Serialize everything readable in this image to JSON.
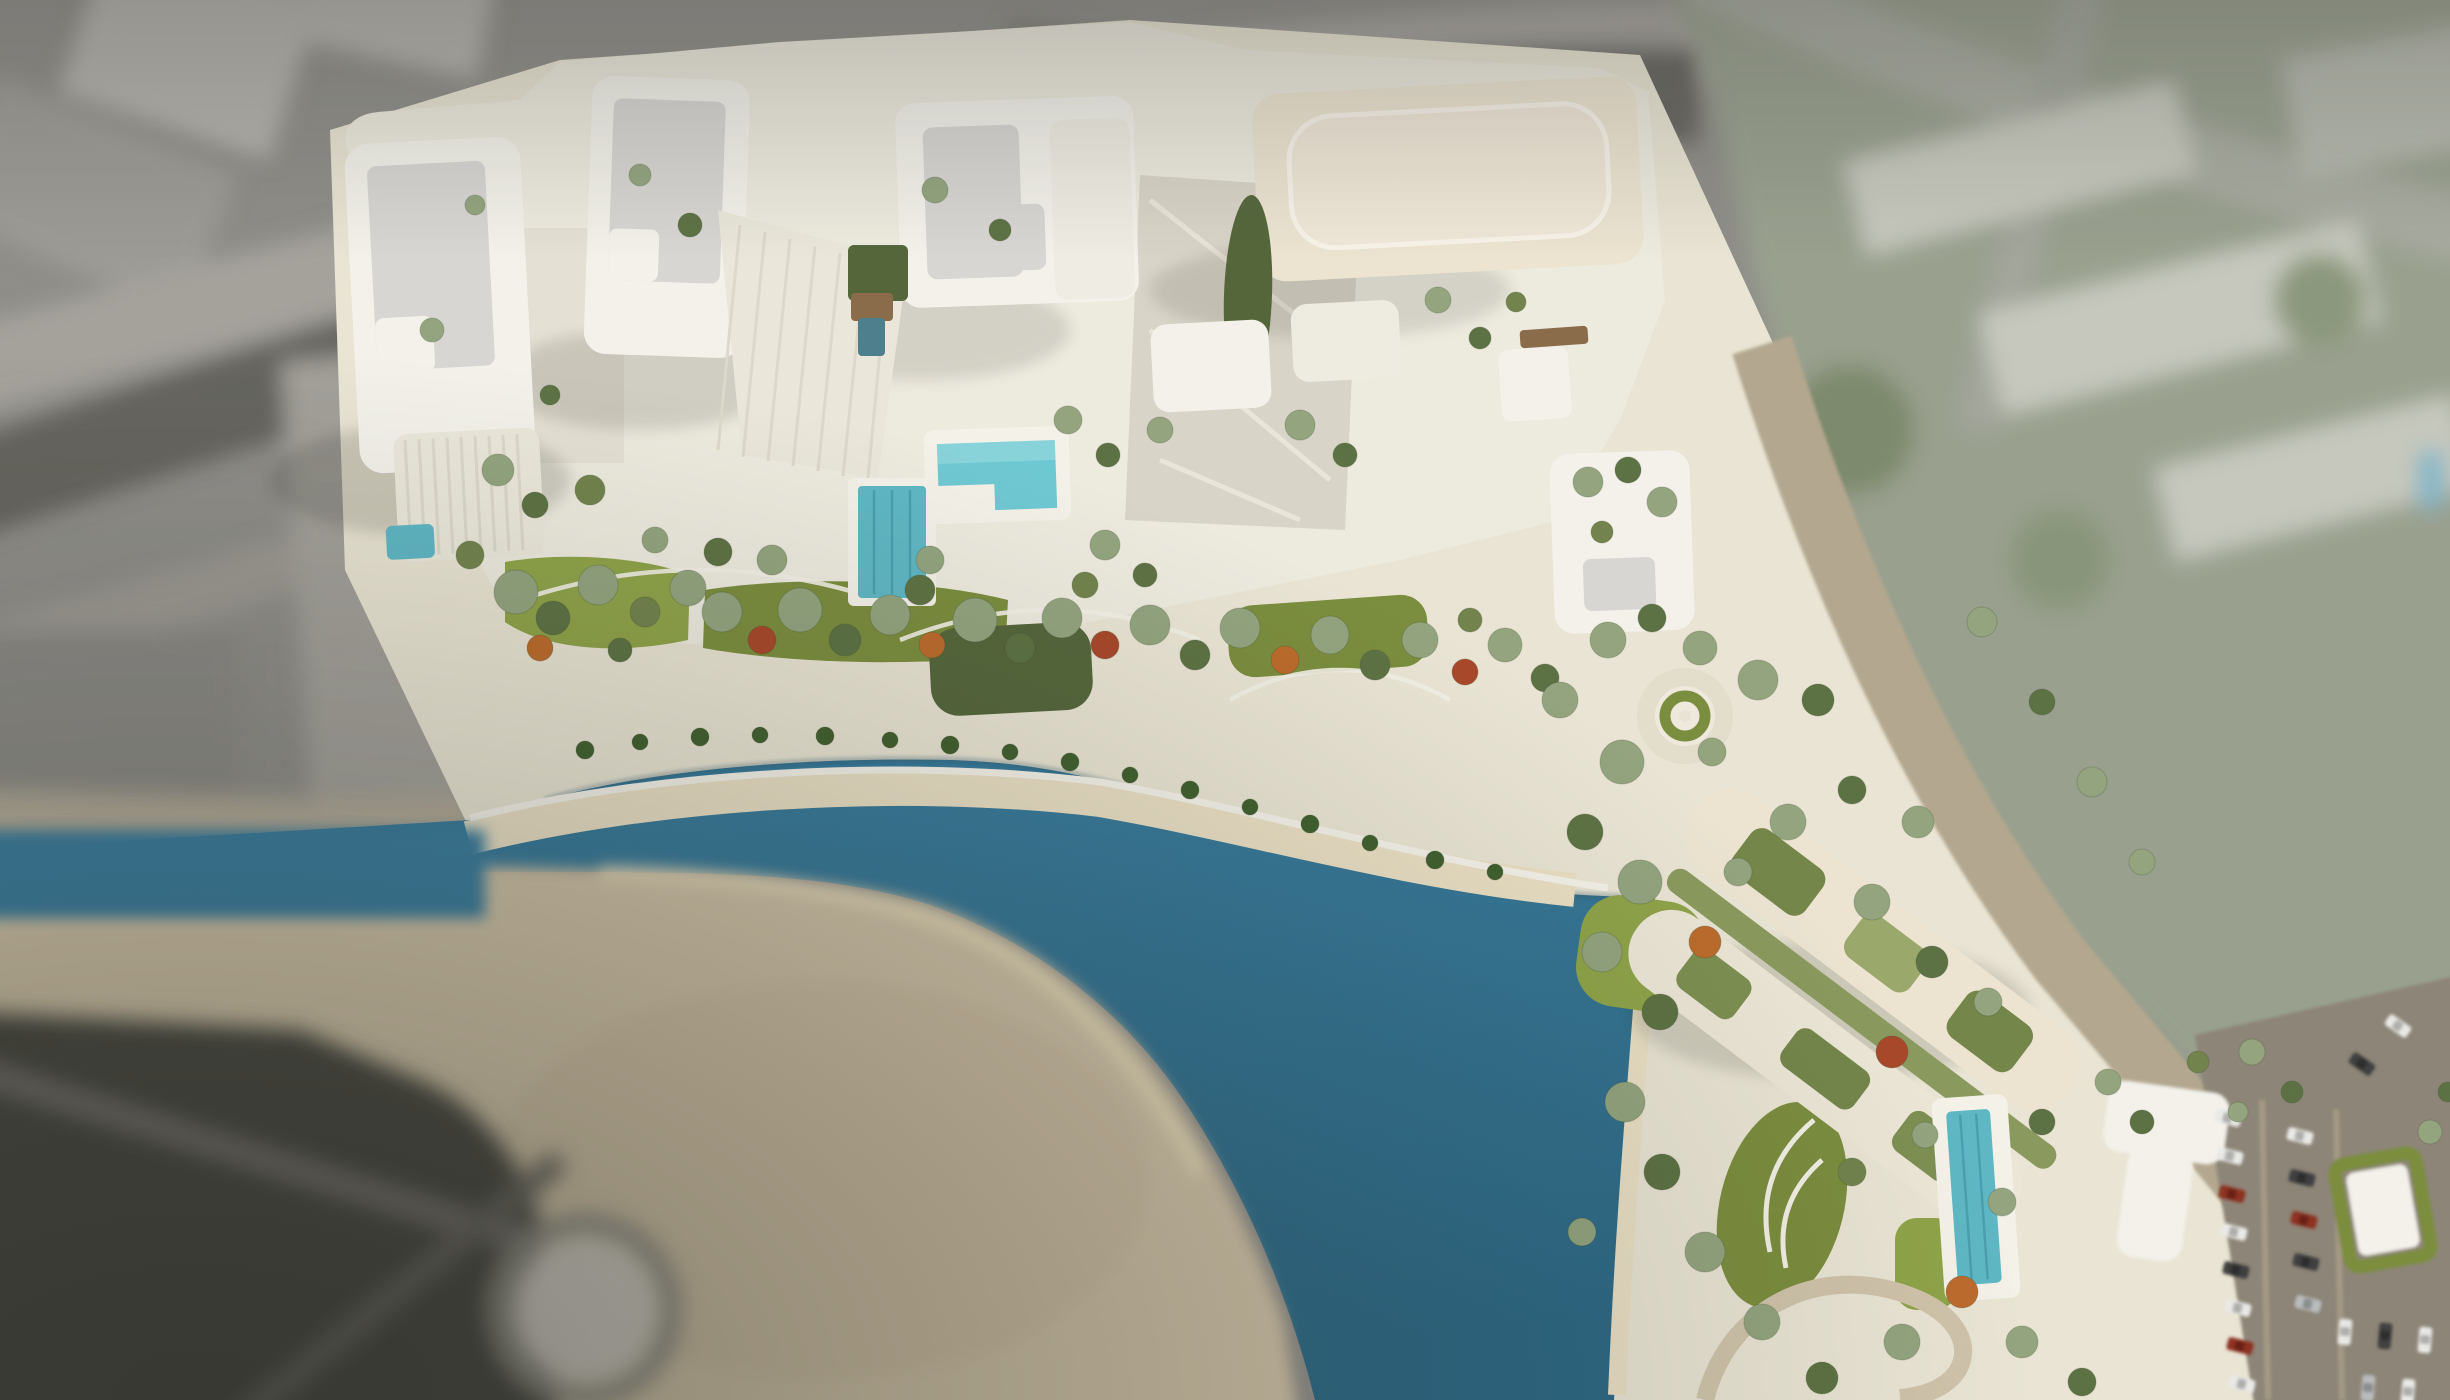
{
  "scene": {
    "type": "aerial-architectural-render",
    "subject": "waterfront resort masterplan with white towers, landscaped gardens, pools, turquoise lagoon and sandy beach",
    "view": "top-down aerial with tilt-shift depth of field (sharp center, blurred city periphery)",
    "landmarks": [
      "tower-a-west",
      "tower-b",
      "tower-c-slab",
      "building-d-north",
      "building-e-rooftop-garden",
      "building-f-diagonal-twin-slabs",
      "stepped-amenity-pool",
      "lap-pool",
      "courtyard-pool",
      "east-garden-pool",
      "lagoon",
      "sand-spit-beach",
      "beach-promenade",
      "central-gardens",
      "circular-lawn-feature",
      "oval-planter-island",
      "roundabout-southwest",
      "coastal-road-east",
      "parking-lot-southeast"
    ],
    "colors": {
      "bg_gray": "#8f8e89",
      "road_light": "#a5a29c",
      "road_dark": "#66655f",
      "blob_white": "#b4b2ac",
      "blob_dark": "#75736d",
      "city_ne_base": "#99a08e",
      "city_ne_slab": "#c6c8bd",
      "city_ne_green": "#7e8a6d",
      "city_ne_pool": "#7fb6c9",
      "corner_dark": "#47463f",
      "roundabout": "#c9c5bc",
      "sand_blur": "#cdc0a5",
      "sand_beach": "#e9dfc4",
      "promenade": "#f4f1e8",
      "water": "#3a7d9e",
      "water_deep": "#2d6884",
      "land_base": "#e9e4d3",
      "podium": "#edeade",
      "plaza": "#d8d4c7",
      "plaza_light": "#e4e0d3",
      "building_white": "#f3f1ea",
      "building_cream": "#ece4d1",
      "roof_gray": "#d8d6d2",
      "roof_panel": "#efe7d7",
      "rib_line": "#dcd8ca",
      "lawn_bright": "#8fa349",
      "lawn_olive": "#7b8d3e",
      "lawn_dark": "#55663b",
      "pool_teal": "#5fb7c4",
      "pool_bright": "#6ec8d2",
      "pool_dark": "#4d7f8c",
      "deck_brown": "#8a6b4a",
      "tree_s": "#93a47f",
      "tree_d": "#5d7244",
      "tree_o": "#72834d",
      "tree_f1": "#bc6b2c",
      "tree_f2": "#a8482a",
      "tree_p": "#41602f",
      "car_white": "#e9e9e6",
      "car_dark": "#3f3f3f",
      "car_red": "#8e3020",
      "car_silver": "#b9bcbd",
      "asphalt": "#8d8577",
      "road_tan": "#b3a78f",
      "shadow": "#2b2b22"
    },
    "trees": [
      [
        516,
        592,
        22,
        "s"
      ],
      [
        553,
        618,
        17,
        "d"
      ],
      [
        470,
        555,
        14,
        "o"
      ],
      [
        598,
        585,
        20,
        "s"
      ],
      [
        645,
        612,
        15,
        "o"
      ],
      [
        688,
        588,
        18,
        "s"
      ],
      [
        540,
        648,
        13,
        "f1"
      ],
      [
        620,
        650,
        12,
        "d"
      ],
      [
        722,
        612,
        20,
        "s"
      ],
      [
        762,
        640,
        14,
        "f2"
      ],
      [
        800,
        610,
        22,
        "s"
      ],
      [
        845,
        640,
        16,
        "d"
      ],
      [
        890,
        615,
        20,
        "s"
      ],
      [
        932,
        645,
        13,
        "f1"
      ],
      [
        920,
        590,
        15,
        "d"
      ],
      [
        975,
        620,
        22,
        "s"
      ],
      [
        1020,
        648,
        15,
        "d"
      ],
      [
        1062,
        618,
        20,
        "s"
      ],
      [
        1105,
        645,
        14,
        "f2"
      ],
      [
        1085,
        585,
        13,
        "o"
      ],
      [
        1150,
        625,
        20,
        "s"
      ],
      [
        1195,
        655,
        15,
        "d"
      ],
      [
        1240,
        628,
        20,
        "s"
      ],
      [
        1285,
        660,
        14,
        "f1"
      ],
      [
        1330,
        635,
        19,
        "s"
      ],
      [
        1375,
        665,
        15,
        "d"
      ],
      [
        1420,
        640,
        18,
        "s"
      ],
      [
        1465,
        672,
        13,
        "f2"
      ],
      [
        1505,
        645,
        17,
        "s"
      ],
      [
        1545,
        678,
        14,
        "d"
      ],
      [
        1470,
        620,
        12,
        "o"
      ],
      [
        1560,
        700,
        18,
        "s"
      ],
      [
        585,
        750,
        9,
        "p"
      ],
      [
        640,
        742,
        8,
        "p"
      ],
      [
        700,
        737,
        9,
        "p"
      ],
      [
        760,
        735,
        8,
        "p"
      ],
      [
        825,
        736,
        9,
        "p"
      ],
      [
        890,
        740,
        8,
        "p"
      ],
      [
        950,
        745,
        9,
        "p"
      ],
      [
        1010,
        752,
        8,
        "p"
      ],
      [
        1070,
        762,
        9,
        "p"
      ],
      [
        1130,
        775,
        8,
        "p"
      ],
      [
        1190,
        790,
        9,
        "p"
      ],
      [
        1250,
        807,
        8,
        "p"
      ],
      [
        1310,
        824,
        9,
        "p"
      ],
      [
        1370,
        843,
        8,
        "p"
      ],
      [
        1435,
        860,
        9,
        "p"
      ],
      [
        1495,
        872,
        8,
        "p"
      ],
      [
        498,
        470,
        16,
        "s"
      ],
      [
        535,
        505,
        13,
        "d"
      ],
      [
        590,
        490,
        15,
        "o"
      ],
      [
        655,
        540,
        13,
        "s"
      ],
      [
        718,
        552,
        14,
        "d"
      ],
      [
        772,
        560,
        15,
        "s"
      ],
      [
        930,
        560,
        14,
        "s"
      ],
      [
        1105,
        545,
        15,
        "s"
      ],
      [
        1145,
        575,
        12,
        "d"
      ],
      [
        640,
        175,
        11,
        "s"
      ],
      [
        690,
        225,
        12,
        "d"
      ],
      [
        475,
        205,
        10,
        "s"
      ],
      [
        432,
        330,
        12,
        "s"
      ],
      [
        550,
        395,
        10,
        "d"
      ],
      [
        935,
        190,
        13,
        "s"
      ],
      [
        1000,
        230,
        11,
        "d"
      ],
      [
        1068,
        420,
        14,
        "s"
      ],
      [
        1108,
        455,
        12,
        "d"
      ],
      [
        1160,
        430,
        13,
        "s"
      ],
      [
        1438,
        300,
        13,
        "s"
      ],
      [
        1480,
        338,
        11,
        "d"
      ],
      [
        1516,
        302,
        10,
        "o"
      ],
      [
        1300,
        425,
        15,
        "s"
      ],
      [
        1345,
        455,
        12,
        "d"
      ],
      [
        1588,
        482,
        15,
        "s"
      ],
      [
        1628,
        470,
        13,
        "d"
      ],
      [
        1662,
        502,
        15,
        "s"
      ],
      [
        1602,
        532,
        11,
        "o"
      ],
      [
        1608,
        640,
        18,
        "s"
      ],
      [
        1652,
        618,
        14,
        "d"
      ],
      [
        1700,
        648,
        17,
        "s"
      ],
      [
        1758,
        680,
        20,
        "s"
      ],
      [
        1818,
        700,
        16,
        "d"
      ],
      [
        1622,
        762,
        22,
        "s"
      ],
      [
        1585,
        832,
        18,
        "d"
      ],
      [
        1640,
        882,
        22,
        "s"
      ],
      [
        1602,
        952,
        20,
        "s"
      ],
      [
        1660,
        1012,
        18,
        "d"
      ],
      [
        1705,
        942,
        16,
        "f1"
      ],
      [
        1738,
        872,
        14,
        "s"
      ],
      [
        1788,
        822,
        18,
        "s"
      ],
      [
        1852,
        790,
        14,
        "d"
      ],
      [
        1918,
        822,
        16,
        "s"
      ],
      [
        1872,
        902,
        18,
        "s"
      ],
      [
        1932,
        962,
        16,
        "d"
      ],
      [
        1988,
        1002,
        14,
        "s"
      ],
      [
        1892,
        1052,
        16,
        "f2"
      ],
      [
        1625,
        1102,
        20,
        "s"
      ],
      [
        1662,
        1172,
        18,
        "d"
      ],
      [
        1705,
        1252,
        20,
        "s"
      ],
      [
        1762,
        1322,
        18,
        "s"
      ],
      [
        1822,
        1378,
        16,
        "d"
      ],
      [
        1902,
        1342,
        18,
        "s"
      ],
      [
        1962,
        1292,
        16,
        "f1"
      ],
      [
        2002,
        1202,
        14,
        "s"
      ],
      [
        2042,
        1122,
        13,
        "d"
      ],
      [
        1852,
        1172,
        14,
        "o"
      ],
      [
        2022,
        1342,
        16,
        "s"
      ],
      [
        2082,
        1382,
        14,
        "d"
      ],
      [
        1582,
        1232,
        14,
        "s"
      ],
      [
        1925,
        1135,
        13,
        "s"
      ],
      [
        1982,
        622,
        15,
        "s"
      ],
      [
        2042,
        702,
        13,
        "d"
      ],
      [
        2092,
        782,
        15,
        "s"
      ],
      [
        2142,
        862,
        13,
        "s"
      ],
      [
        2252,
        1052,
        13,
        "s"
      ],
      [
        2292,
        1092,
        11,
        "d"
      ],
      [
        2238,
        1112,
        10,
        "s"
      ],
      [
        2198,
        1062,
        11,
        "o"
      ],
      [
        2430,
        1132,
        12,
        "s"
      ],
      [
        2448,
        1092,
        10,
        "d"
      ],
      [
        1712,
        752,
        14,
        "s"
      ],
      [
        2108,
        1082,
        13,
        "s"
      ],
      [
        2142,
        1122,
        12,
        "d"
      ]
    ],
    "cars": [
      [
        2228,
        1118,
        14,
        "white"
      ],
      [
        2230,
        1156,
        14,
        "white"
      ],
      [
        2232,
        1194,
        14,
        "red"
      ],
      [
        2234,
        1232,
        14,
        "white"
      ],
      [
        2236,
        1270,
        14,
        "dark"
      ],
      [
        2238,
        1308,
        14,
        "white"
      ],
      [
        2240,
        1346,
        14,
        "red"
      ],
      [
        2242,
        1384,
        14,
        "white"
      ],
      [
        2300,
        1136,
        14,
        "white"
      ],
      [
        2302,
        1178,
        14,
        "dark"
      ],
      [
        2304,
        1220,
        14,
        "red"
      ],
      [
        2306,
        1262,
        14,
        "dark"
      ],
      [
        2308,
        1304,
        14,
        "silver"
      ],
      [
        2345,
        1332,
        95,
        "white"
      ],
      [
        2385,
        1336,
        95,
        "dark"
      ],
      [
        2425,
        1340,
        95,
        "white"
      ],
      [
        2368,
        1388,
        95,
        "silver"
      ],
      [
        2408,
        1392,
        95,
        "white"
      ],
      [
        2398,
        1026,
        35,
        "white"
      ],
      [
        2362,
        1064,
        35,
        "dark"
      ]
    ]
  }
}
